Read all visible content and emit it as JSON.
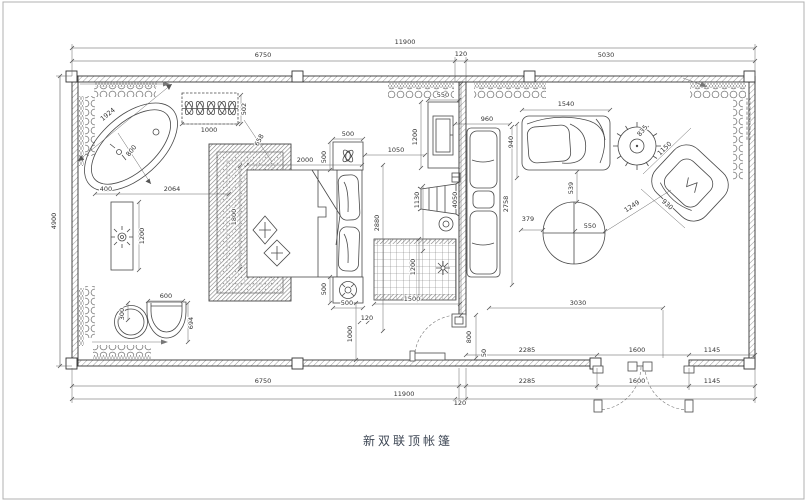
{
  "title": "新双联顶帐篷",
  "colors": {
    "line": "#4a4a4a",
    "dimension_text": "#333333",
    "wall_hatch": "#9a9a9a",
    "title_text": "#3d4654",
    "background": "#ffffff"
  },
  "components": [
    "bathtub",
    "vanity-counter",
    "planter-box",
    "wash-basin",
    "stool",
    "bedroom-rug",
    "double-bed",
    "pillows",
    "nightstand-with-plant",
    "nightstand-with-lamp",
    "tv-cabinet",
    "luggage-rack",
    "grid-rug",
    "sectional-sofa",
    "chaise-lounge",
    "potted-plant",
    "round-table",
    "swivel-armchair",
    "single-door",
    "double-door",
    "curtains"
  ],
  "dimension_labels": [
    {
      "t": "11900",
      "x": 405,
      "y": 44
    },
    {
      "t": "6750",
      "x": 263,
      "y": 57
    },
    {
      "t": "120",
      "x": 461,
      "y": 56
    },
    {
      "t": "5030",
      "x": 606,
      "y": 57
    },
    {
      "t": "4900",
      "x": 56,
      "y": 221,
      "r": -90
    },
    {
      "t": "1924",
      "x": 109,
      "y": 116,
      "r": -39
    },
    {
      "t": "800",
      "x": 133,
      "y": 152,
      "r": -52
    },
    {
      "t": "1000",
      "x": 209,
      "y": 132
    },
    {
      "t": "502",
      "x": 246,
      "y": 109,
      "r": -90
    },
    {
      "t": "400",
      "x": 106,
      "y": 191
    },
    {
      "t": "2064",
      "x": 172,
      "y": 191
    },
    {
      "t": "1200",
      "x": 144,
      "y": 236,
      "r": -90
    },
    {
      "t": "300",
      "x": 124,
      "y": 314,
      "r": -90
    },
    {
      "t": "600",
      "x": 166,
      "y": 298
    },
    {
      "t": "694",
      "x": 193,
      "y": 323,
      "r": -90
    },
    {
      "t": "1800",
      "x": 236,
      "y": 217,
      "r": -90
    },
    {
      "t": "2000",
      "x": 305,
      "y": 162
    },
    {
      "t": "658",
      "x": 261,
      "y": 141,
      "r": -62
    },
    {
      "t": "500",
      "x": 348,
      "y": 136
    },
    {
      "t": "500",
      "x": 326,
      "y": 157,
      "r": -90
    },
    {
      "t": "550",
      "x": 443,
      "y": 97
    },
    {
      "t": "1200",
      "x": 417,
      "y": 137,
      "r": -90
    },
    {
      "t": "1050",
      "x": 396,
      "y": 152
    },
    {
      "t": "1130",
      "x": 419,
      "y": 200,
      "r": -90
    },
    {
      "t": "2880",
      "x": 379,
      "y": 223,
      "r": -90
    },
    {
      "t": "4050",
      "x": 457,
      "y": 200,
      "r": -90
    },
    {
      "t": "500",
      "x": 326,
      "y": 289,
      "r": -90
    },
    {
      "t": "500",
      "x": 347,
      "y": 305
    },
    {
      "t": "120",
      "x": 367,
      "y": 320
    },
    {
      "t": "1000",
      "x": 352,
      "y": 334,
      "r": -90
    },
    {
      "t": "1200",
      "x": 415,
      "y": 267,
      "r": -90
    },
    {
      "t": "1500",
      "x": 412,
      "y": 301
    },
    {
      "t": "960",
      "x": 487,
      "y": 121
    },
    {
      "t": "940",
      "x": 513,
      "y": 142,
      "r": -90
    },
    {
      "t": "2758",
      "x": 508,
      "y": 204,
      "r": -90
    },
    {
      "t": "379",
      "x": 528,
      "y": 221
    },
    {
      "t": "1540",
      "x": 566,
      "y": 106
    },
    {
      "t": "835",
      "x": 644,
      "y": 132,
      "r": -50
    },
    {
      "t": "539",
      "x": 573,
      "y": 188,
      "r": -90
    },
    {
      "t": "550",
      "x": 590,
      "y": 228
    },
    {
      "t": "1249",
      "x": 633,
      "y": 208,
      "r": -33
    },
    {
      "t": "1150",
      "x": 666,
      "y": 150,
      "r": -44
    },
    {
      "t": "930",
      "x": 666,
      "y": 206,
      "r": 42
    },
    {
      "t": "3030",
      "x": 578,
      "y": 305
    },
    {
      "t": "800",
      "x": 471,
      "y": 337,
      "r": -90
    },
    {
      "t": "50",
      "x": 486,
      "y": 353,
      "r": -90
    },
    {
      "t": "2285",
      "x": 527,
      "y": 352
    },
    {
      "t": "1600",
      "x": 637,
      "y": 352
    },
    {
      "t": "1145",
      "x": 712,
      "y": 352
    },
    {
      "t": "6750",
      "x": 263,
      "y": 383
    },
    {
      "t": "2285",
      "x": 527,
      "y": 383
    },
    {
      "t": "1600",
      "x": 637,
      "y": 383
    },
    {
      "t": "1145",
      "x": 712,
      "y": 383
    },
    {
      "t": "11900",
      "x": 404,
      "y": 396
    },
    {
      "t": "120",
      "x": 460,
      "y": 405
    }
  ]
}
